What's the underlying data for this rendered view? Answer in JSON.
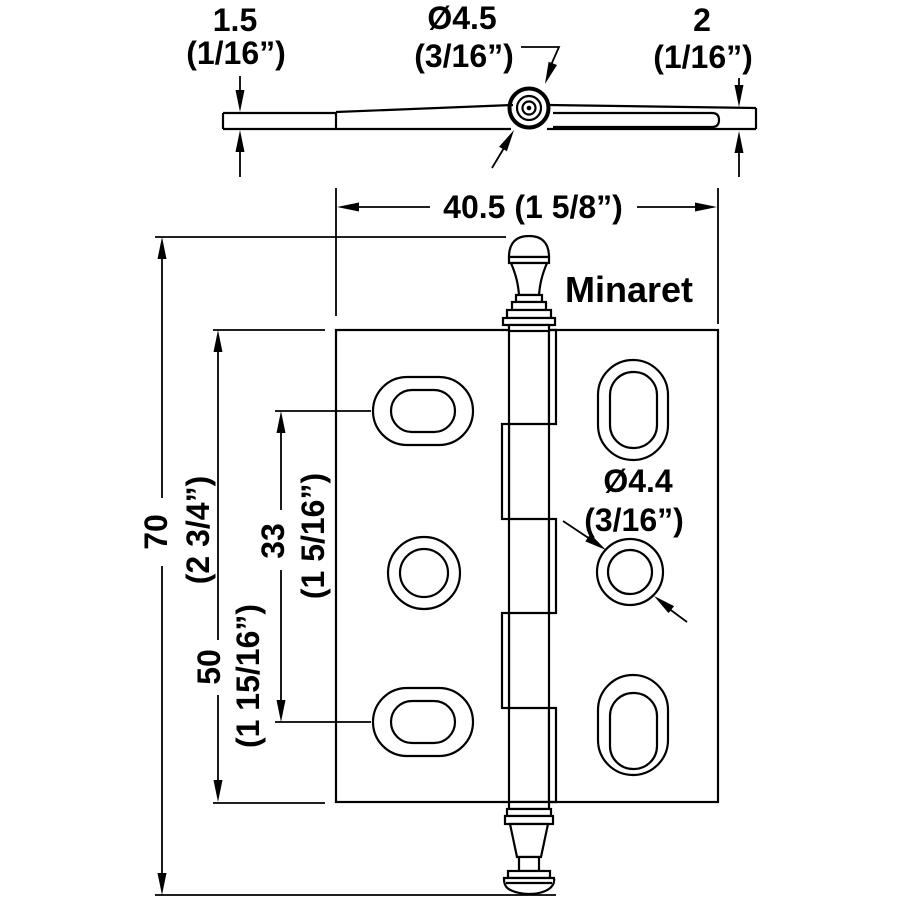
{
  "style_label": "Minaret",
  "side_view": {
    "leaf1_thickness_mm": "1.5",
    "leaf1_thickness_in": "(1/16”)",
    "pin_diameter_mm": "Ø4.5",
    "pin_diameter_in": "(3/16”)",
    "leaf2_thickness_mm": "2",
    "leaf2_thickness_in": "(1/16”)"
  },
  "front_view": {
    "width_label": "40.5 (1 5/8”)",
    "overall_height_mm": "70",
    "overall_height_in": "(2 3/4”)",
    "leaf_height_mm": "50",
    "leaf_height_in": "(1 15/16”)",
    "hole_pitch_mm": "33",
    "hole_pitch_in": "(1 5/16”)",
    "screw_hole_diameter_mm": "Ø4.4",
    "screw_hole_diameter_in": "(3/16”)"
  },
  "colors": {
    "ink": "#000000",
    "paper": "#ffffff"
  }
}
